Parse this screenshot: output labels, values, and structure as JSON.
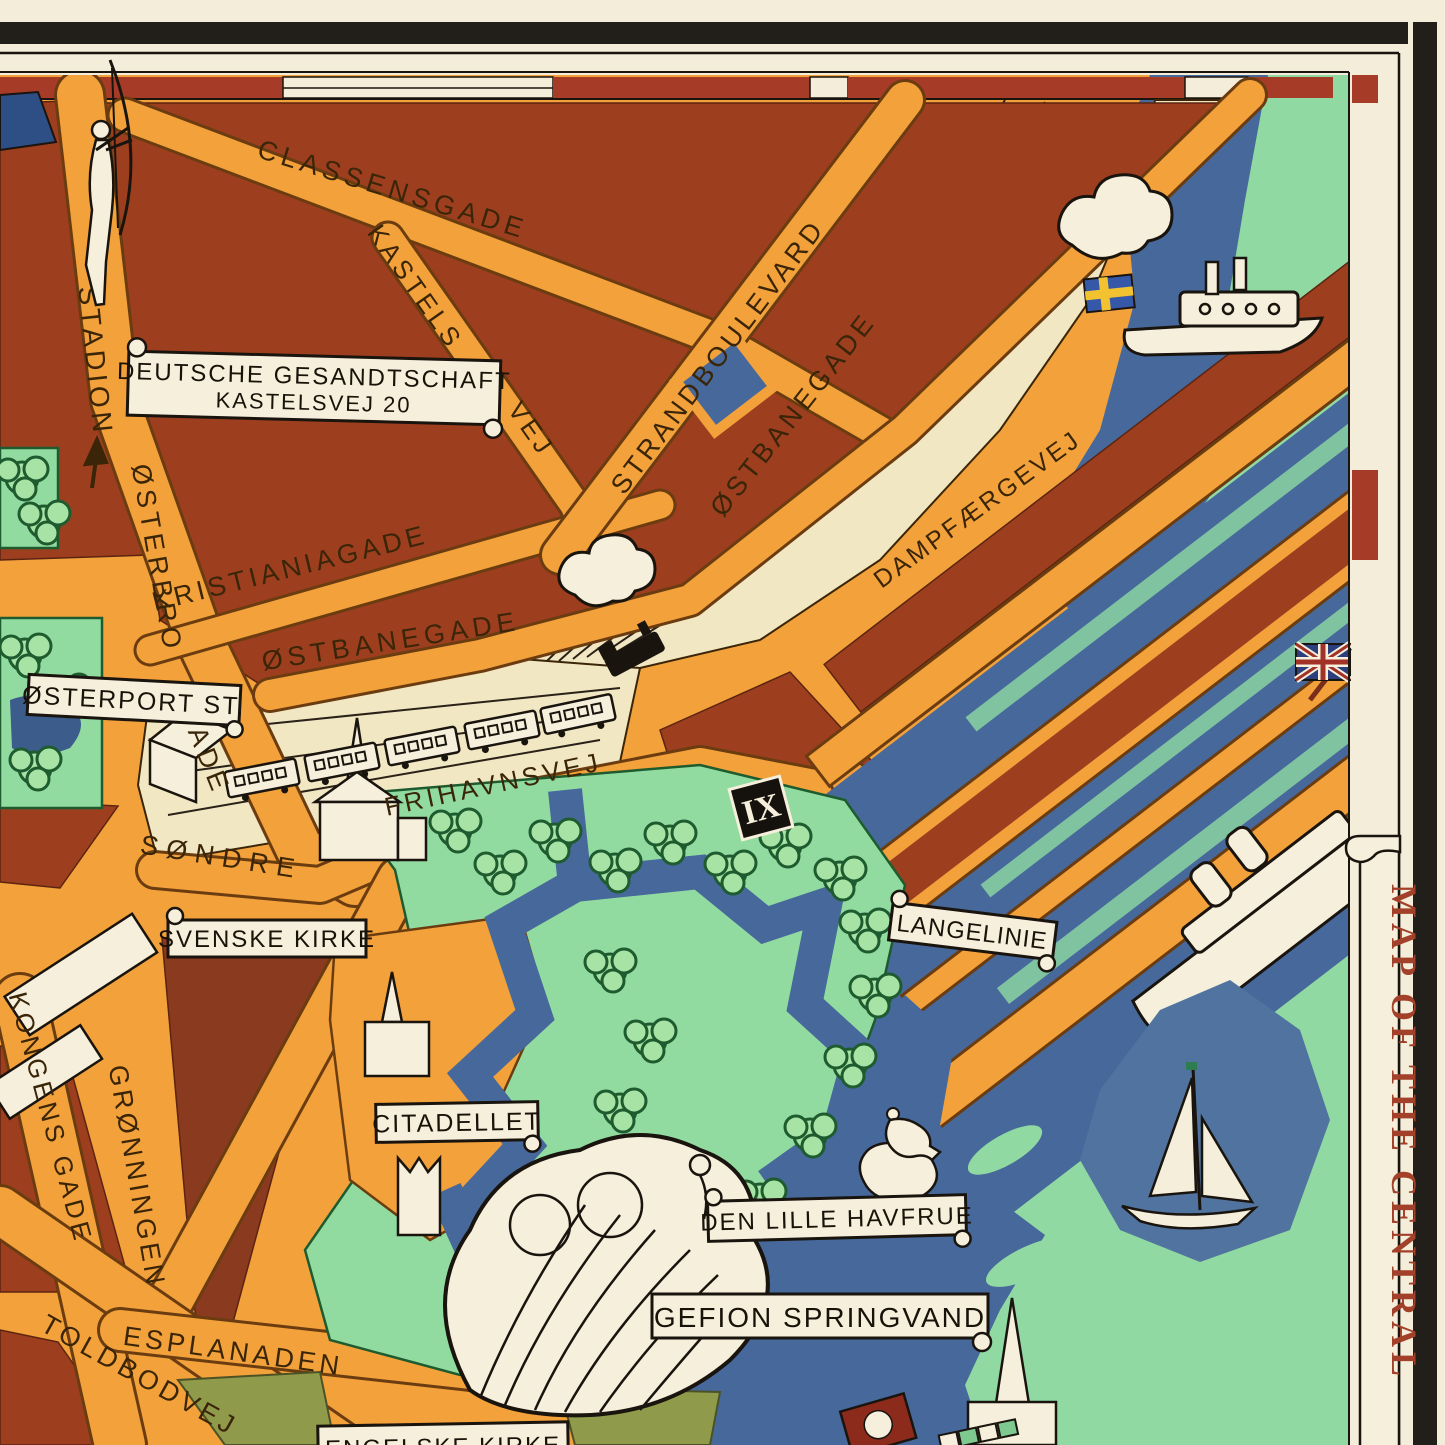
{
  "map": {
    "title_banner": {
      "text": "MAP OF THE CENTRAL"
    },
    "streets": [
      {
        "id": "classensgade",
        "label": "CLASSENSGADE"
      },
      {
        "id": "kastels",
        "label": "KASTELS"
      },
      {
        "id": "kastels-vej",
        "label": "VEJ"
      },
      {
        "id": "stadion",
        "label": "STADION"
      },
      {
        "id": "osterbro",
        "label": "ØSTERBRO"
      },
      {
        "id": "osterbro-gade",
        "label": "GADE"
      },
      {
        "id": "kristianiagade",
        "label": "KRISTIANIAGADE"
      },
      {
        "id": "strandboulevard",
        "label": "STRANDBOULEVARD"
      },
      {
        "id": "ostbanegade-upper",
        "label": "ØSTBANEGADE"
      },
      {
        "id": "ostbanegade-lower",
        "label": "ØSTBANEGADE"
      },
      {
        "id": "dampfaergevej",
        "label": "DAMPFÆRGEVEJ"
      },
      {
        "id": "sondre",
        "label": "SØNDRE"
      },
      {
        "id": "frihavnsvej",
        "label": "FRIHAVNSVEJ"
      },
      {
        "id": "kongens-gade",
        "label": "KONGENS GADE"
      },
      {
        "id": "gronningen",
        "label": "GRØNNINGEN"
      },
      {
        "id": "toldbodvej",
        "label": "TOLDBODVEJ"
      },
      {
        "id": "esplanaden",
        "label": "ESPLANADEN"
      }
    ],
    "signs": [
      {
        "id": "deutsche-gesandtschaft",
        "line1": "DEUTSCHE GESANDTSCHAFT",
        "line2": "KASTELSVEJ 20"
      },
      {
        "id": "osterport-st",
        "label": "ØSTERPORT ST."
      },
      {
        "id": "svenske-kirke",
        "label": "SVENSKE KIRKE"
      },
      {
        "id": "langelinie",
        "label": "LANGELINIE"
      },
      {
        "id": "citadellet",
        "label": "CITADELLET"
      },
      {
        "id": "den-lille-havfrue",
        "label": "DEN LILLE HAVFRUE"
      },
      {
        "id": "gefion-springvand",
        "label": "GEFION SPRINGVAND"
      },
      {
        "id": "engelske-kirke",
        "label": "ENGELSKE KIRKE"
      }
    ],
    "markers": [
      {
        "id": "pier-ix",
        "label": "IX"
      }
    ],
    "icons": [
      "archer-statue-icon",
      "swedish-flag-icon",
      "steam-ferry-icon",
      "locomotive-icon",
      "train-carriage-icon",
      "union-jack-flag-icon",
      "ocean-liner-icon",
      "sailboat-icon",
      "mermaid-statue-icon",
      "gefion-fountain-icon",
      "tree-icon",
      "church-icon",
      "citadel-gate-icon",
      "ship-flag-icon",
      "stadion-arrow-icon"
    ],
    "colors": {
      "paper": "#f3edd9",
      "frame_black": "#221e19",
      "street_orange": "#f2a13b",
      "block_red": "#9d3f1f",
      "sea_green": "#90d9a2",
      "water_blue": "#46689a",
      "rail_cream": "#f2e7c3",
      "park_green": "#92dba0",
      "tree_green": "#a6e3a4",
      "olive": "#8f9b4a",
      "banner_red": "#a2402a"
    }
  }
}
